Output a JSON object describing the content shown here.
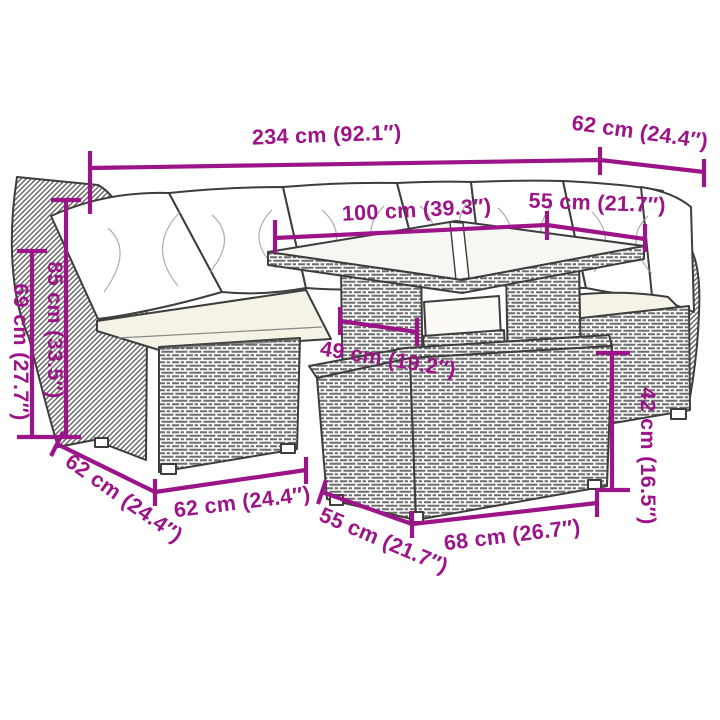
{
  "image": {
    "type": "product-dimension-diagram",
    "subject": "poly rattan garden lounge set with glass-top table and footstool",
    "background": "#ffffff"
  },
  "colors": {
    "dimension_accent": "#9C1588",
    "drawing_outline": "#3D3D3D",
    "weave_texture": "#6E6E6E",
    "back_cushion": "#FFFFFF",
    "seat_cushion": "#F5F2E6"
  },
  "dimensions": {
    "overall_width": "234 cm (92.1″)",
    "corner_section_depth": "62 cm (24.4″)",
    "table_length": "100 cm (39.3″)",
    "right_seat_width": "55 cm (21.7″)",
    "total_height": "85 cm (33.5″)",
    "armrest_height": "69 cm (27.7″)",
    "table_leg_clearance": "49 cm (19.2″)",
    "footstool_height": "42 cm (16.5″)",
    "section_depth": "62 cm (24.4″)",
    "left_seat_width": "62 cm (24.4″)",
    "footstool_depth": "55 cm (21.7″)",
    "footstool_width": "68 cm (26.7″)"
  }
}
